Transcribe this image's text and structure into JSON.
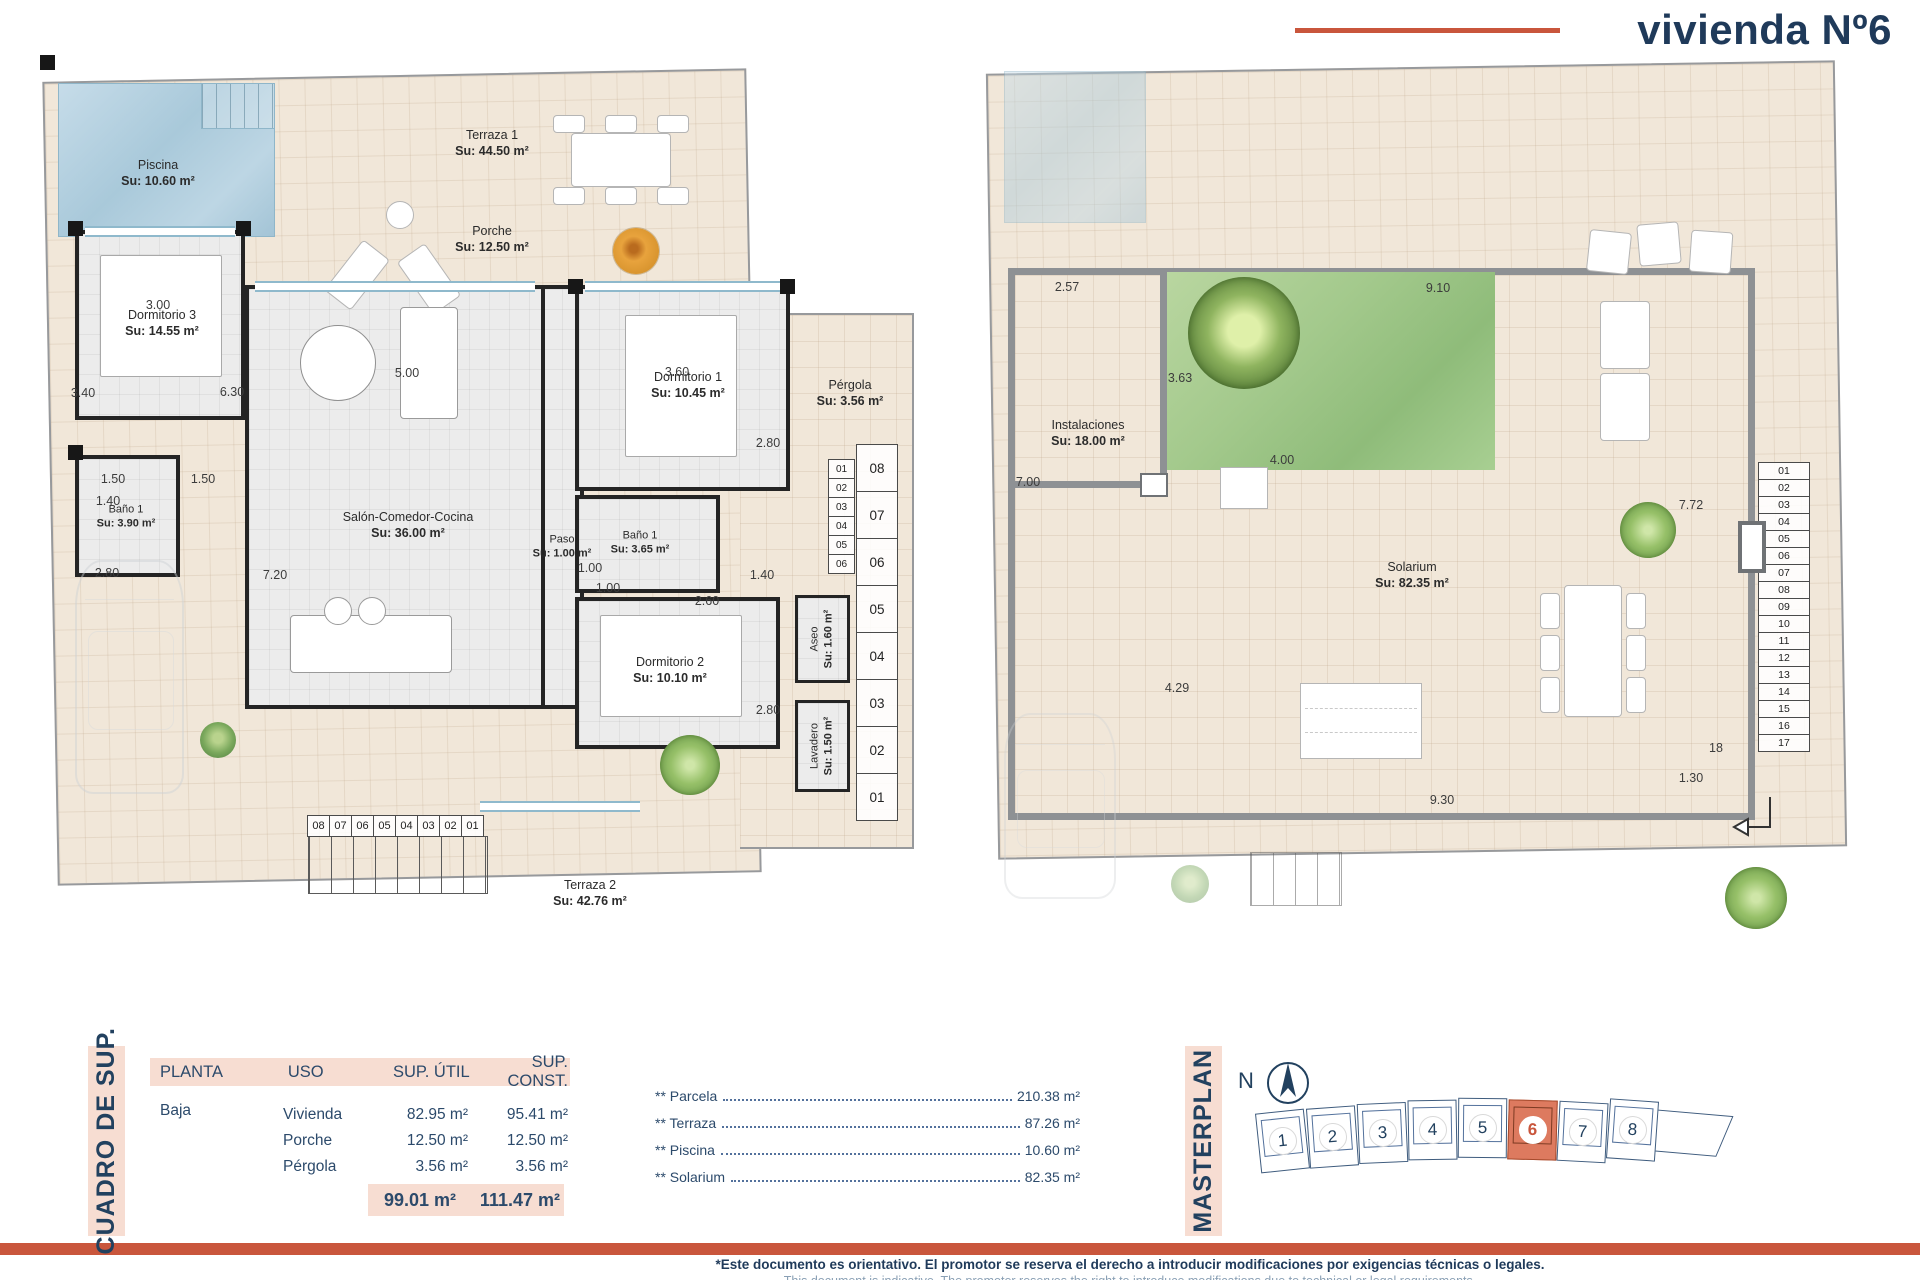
{
  "title": "vivienda Nº6",
  "ground": {
    "rooms": {
      "piscina": {
        "n": "Piscina",
        "a": "Su: 10.60 m²"
      },
      "terraza1": {
        "n": "Terraza 1",
        "a": "Su: 44.50 m²"
      },
      "porche": {
        "n": "Porche",
        "a": "Su: 12.50 m²"
      },
      "dorm3": {
        "n": "Dormitorio 3",
        "a": "Su: 14.55 m²"
      },
      "bano1l": {
        "n": "Baño 1",
        "a": "Su: 3.90 m²"
      },
      "salon": {
        "n": "Salón-Comedor-Cocina",
        "a": "Su: 36.00 m²"
      },
      "paso": {
        "n": "Paso",
        "a": "Su: 1.00 m²"
      },
      "dorm1": {
        "n": "Dormitorio 1",
        "a": "Su: 10.45 m²"
      },
      "bano1r": {
        "n": "Baño 1",
        "a": "Su: 3.65 m²"
      },
      "dorm2": {
        "n": "Dormitorio 2",
        "a": "Su: 10.10 m²"
      },
      "aseo": {
        "n": "Aseo",
        "a": "Su: 1.60 m²"
      },
      "lavadero": {
        "n": "Lavadero",
        "a": "Su: 1.50 m²"
      },
      "pergola": {
        "n": "Pérgola",
        "a": "Su: 3.56 m²"
      },
      "terraza2": {
        "n": "Terraza 2",
        "a": "Su: 42.76 m²"
      }
    },
    "dims": {
      "dorm3_top": "3.00",
      "dorm3_left": "3.40",
      "dorm3_right": "6.30",
      "split_a": "1.50",
      "split_b": "1.50",
      "bano1l_top": "1.40",
      "bano1l_mid": "2.80",
      "salon_top": "5.00",
      "salon_left": "7.20",
      "dorm1_top": "3.60",
      "dorm1_right": "2.80",
      "paso_a": "1.00",
      "paso_b": "1.00",
      "bano1r_bottom": "2.60",
      "bano1r_right": "1.40",
      "dorm2_right": "2.80",
      "dorm2_bottom": "3.60"
    },
    "stair_out": [
      "08",
      "07",
      "06",
      "05",
      "04",
      "03",
      "02",
      "01"
    ],
    "stair_in": [
      "01",
      "02",
      "03",
      "04",
      "05",
      "06"
    ],
    "stair_h": [
      "08",
      "07",
      "06",
      "05",
      "04",
      "03",
      "02",
      "01"
    ]
  },
  "roof": {
    "rooms": {
      "instalaciones": {
        "n": "Instalaciones",
        "a": "Su: 18.00 m²"
      },
      "solarium": {
        "n": "Solarium",
        "a": "Su: 82.35 m²"
      }
    },
    "dims": {
      "top_left": "2.57",
      "top_right": "9.10",
      "garden_left": "3.63",
      "garden_bottom": "4.00",
      "left": "7.00",
      "right": "7.72",
      "mid": "4.29",
      "bottom": "9.30",
      "stair_w": "1.30",
      "step18": "18"
    },
    "stair": [
      "01",
      "02",
      "03",
      "04",
      "05",
      "06",
      "07",
      "08",
      "09",
      "10",
      "11",
      "12",
      "13",
      "14",
      "15",
      "16",
      "17"
    ]
  },
  "summary": {
    "side_label": "CUADRO DE SUP.",
    "headers": {
      "planta": "PLANTA",
      "uso": "USO",
      "util": "SUP. ÚTIL",
      "construida": "SUP. CONST."
    },
    "floor": "Baja",
    "rows": [
      {
        "uso": "Vivienda",
        "util": "82.95 m²",
        "cons": "95.41 m²"
      },
      {
        "uso": "Porche",
        "util": "12.50 m²",
        "cons": "12.50 m²"
      },
      {
        "uso": "Pérgola",
        "util": "3.56 m²",
        "cons": "3.56 m²"
      }
    ],
    "total_util": "99.01 m²",
    "total_cons": "111.47 m²",
    "extras": [
      {
        "label": "** Parcela",
        "value": "210.38 m²"
      },
      {
        "label": "** Terraza",
        "value": "87.26 m²"
      },
      {
        "label": "** Piscina",
        "value": "10.60 m²"
      },
      {
        "label": "** Solarium",
        "value": "82.35 m²"
      }
    ]
  },
  "masterplan": {
    "side_label": "MASTERPLAN",
    "north": "N",
    "plots": [
      "1",
      "2",
      "3",
      "4",
      "5",
      "6",
      "7",
      "8"
    ],
    "active_plot": "6"
  },
  "footer": {
    "line1": "*Este documento es orientativo. El promotor se reserva el derecho a introducir modificaciones por exigencias técnicas o legales.",
    "line2": "This document is indicative. The promoter reserves the right to introduce modifications due to technical or legal requirements."
  },
  "colors": {
    "accent": "#c9563c",
    "navy": "#22415f",
    "pink": "#f7ddd2",
    "highlight": "#dd7a5f"
  }
}
